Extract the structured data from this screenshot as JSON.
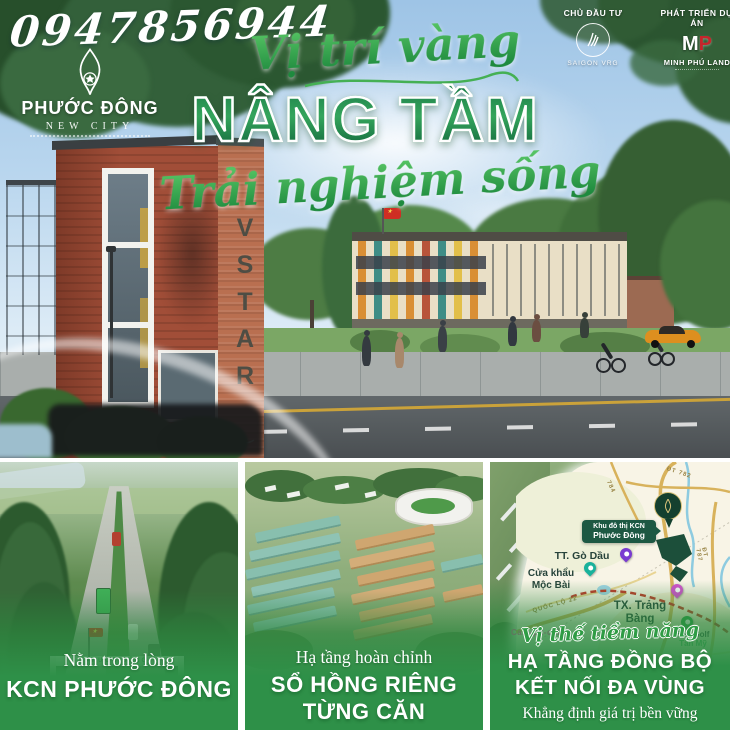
{
  "phone": "0947856944",
  "brand": {
    "name": "PHƯỚC ĐÔNG",
    "subtitle": "NEW CITY"
  },
  "partners": {
    "investor_label": "CHỦ ĐẦU TƯ",
    "investor_name": "SAIGON VRG",
    "developer_label": "PHÁT TRIỂN DỰ ÁN",
    "developer_monogram_m": "M",
    "developer_monogram_p": "P",
    "developer_name": "MINH PHÚ LAND"
  },
  "headline": {
    "kicker": "Vị trí vàng",
    "main": "NÂNG TẦM",
    "sub": "Trải nghiệm sống"
  },
  "scene": {
    "building_sign": "VSTAR"
  },
  "panels": {
    "left": {
      "kicker": "Nằm trong lòng",
      "title": "KCN PHƯỚC ĐÔNG",
      "gate_sign": "PHƯỚC ĐÔNG"
    },
    "middle": {
      "kicker": "Hạ tầng hoàn chỉnh",
      "title_line1": "SỔ HỒNG RIÊNG",
      "title_line2": "TỪNG CĂN"
    },
    "right": {
      "kicker": "Vị thế tiềm năng",
      "title_line1": "HẠ TẦNG ĐỒNG BỘ",
      "title_line2": "KẾT NỐI ĐA VÙNG",
      "tagline": "Khẳng định giá trị bền vững"
    }
  },
  "map": {
    "callout_line1": "Khu đô thị KCN",
    "callout_line2": "Phước Đông",
    "labels": {
      "town1": "TT. Gò Dầu",
      "border_gate_line1": "Cửa khẩu",
      "border_gate_line2": "Mộc Bài",
      "highway": "QUỐC LỘ 22",
      "town2_line1": "TX. Trảng",
      "town2_line2": "Bàng",
      "golf_line1": "Sân Golf",
      "golf_line2": "Tân Mỹ",
      "country": "Cam-pu-chia",
      "road_784": "784",
      "road_787": "ĐT 787",
      "road_782": "ĐT 782"
    }
  },
  "colors": {
    "accent_green": "#2e9048",
    "dark_green": "#155c38",
    "brand_red": "#c6252b",
    "map_road": "#d8b25c",
    "map_river": "#86c7dd",
    "map_planned_road": "#c43528"
  }
}
